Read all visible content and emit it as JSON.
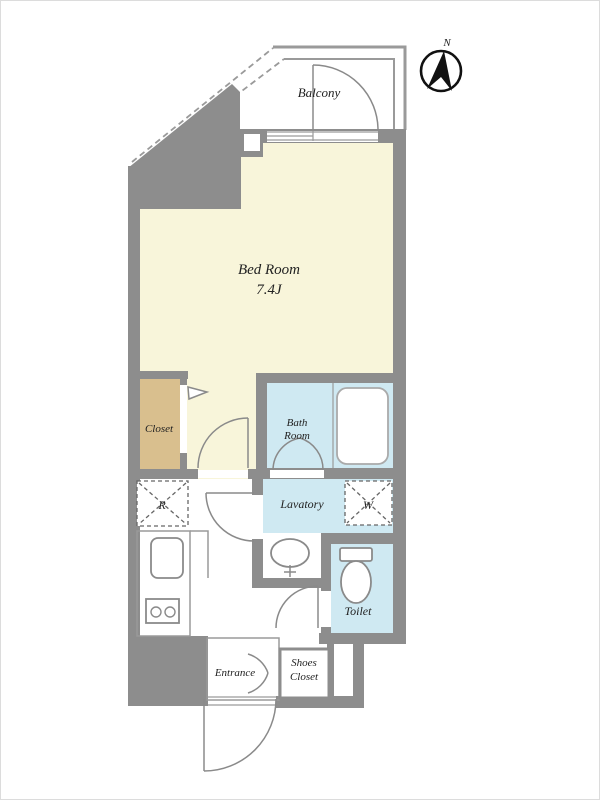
{
  "title": "Apartment floor plan",
  "colors": {
    "wall": "#8d8d8d",
    "bedroom_floor": "#f8f5da",
    "closet_floor": "#d9bf8e",
    "wet_area_floor": "#cfe9f2",
    "thin_line": "#9a9a9a",
    "fixture_line": "#8a8a8a",
    "text": "#222222",
    "compass": "#111111"
  },
  "compass": {
    "label": "N"
  },
  "rooms": [
    {
      "id": "balcony",
      "label": "Balcony"
    },
    {
      "id": "bedroom",
      "label": "Bed Room",
      "size": "7.4J"
    },
    {
      "id": "closet",
      "label": "Closet"
    },
    {
      "id": "bathroom",
      "label": "Bath Room"
    },
    {
      "id": "lavatory",
      "label": "Lavatory"
    },
    {
      "id": "refrigerator-space",
      "label": "R"
    },
    {
      "id": "washer-space",
      "label": "W"
    },
    {
      "id": "toilet",
      "label": "Toilet"
    },
    {
      "id": "entrance",
      "label": "Entrance"
    },
    {
      "id": "shoes-closet",
      "label": "Shoes Closet"
    }
  ],
  "labels": [
    {
      "name": "balcony-label",
      "text": "Balcony",
      "x": 318,
      "y": 96,
      "size": 13
    },
    {
      "name": "bedroom-label",
      "text": "Bed Room",
      "x": 268,
      "y": 273,
      "size": 15
    },
    {
      "name": "bedroom-size-label",
      "text": "7.4J",
      "x": 268,
      "y": 293,
      "size": 15
    },
    {
      "name": "closet-label",
      "text": "Closet",
      "x": 158,
      "y": 431,
      "size": 11
    },
    {
      "name": "bathroom-label-line1",
      "text": "Bath",
      "x": 296,
      "y": 425,
      "size": 11
    },
    {
      "name": "bathroom-label-line2",
      "text": "Room",
      "x": 296,
      "y": 438,
      "size": 11
    },
    {
      "name": "lavatory-label",
      "text": "Lavatory",
      "x": 301,
      "y": 507,
      "size": 12
    },
    {
      "name": "refrigerator-space-label",
      "text": "R",
      "x": 161,
      "y": 508,
      "size": 12
    },
    {
      "name": "washer-space-label",
      "text": "W",
      "x": 367,
      "y": 508,
      "size": 12
    },
    {
      "name": "toilet-label",
      "text": "Toilet",
      "x": 357,
      "y": 614,
      "size": 12
    },
    {
      "name": "entrance-label",
      "text": "Entrance",
      "x": 234,
      "y": 675,
      "size": 11
    },
    {
      "name": "shoes-closet-label-line1",
      "text": "Shoes",
      "x": 303,
      "y": 665,
      "size": 11
    },
    {
      "name": "shoes-closet-label-line2",
      "text": "Closet",
      "x": 303,
      "y": 679,
      "size": 11
    },
    {
      "name": "north-label",
      "text": "N",
      "x": 446,
      "y": 45,
      "size": 11
    }
  ]
}
